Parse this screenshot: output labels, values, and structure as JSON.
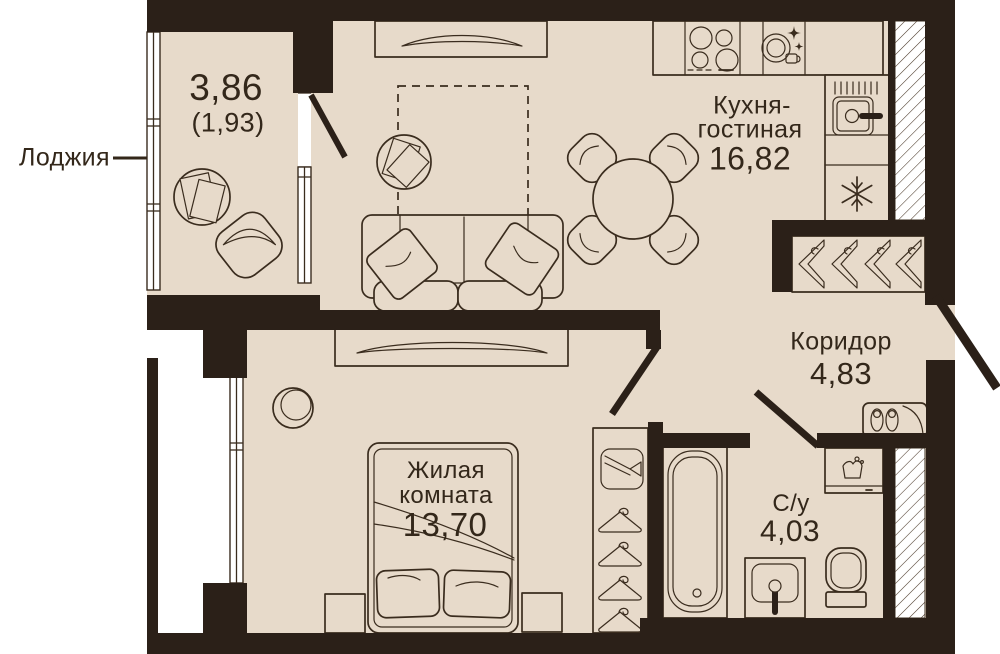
{
  "plan_type": "apartment-floor-plan",
  "colors": {
    "wall": "#2B2018",
    "floor": "#E7DACA",
    "outline": "#3A2C1E",
    "window": "#FFFFFF",
    "hatch_line": "#4A3929",
    "background": "#FFFFFF",
    "text": "#33271A"
  },
  "rooms": [
    {
      "key": "loggia",
      "name": "Лоджия",
      "area": "3,86",
      "area_secondary": "(1,93)"
    },
    {
      "key": "kitchen_living",
      "name_line1": "Кухня-",
      "name_line2": "гостиная",
      "area": "16,82"
    },
    {
      "key": "corridor",
      "name": "Коридор",
      "area": "4,83"
    },
    {
      "key": "bedroom",
      "name_line1": "Жилая",
      "name_line2": "комната",
      "area": "13,70"
    },
    {
      "key": "bathroom",
      "name": "С/у",
      "area": "4,03"
    }
  ],
  "icons": [
    "stove-burners-icon",
    "dishwasher-sparkle-icon",
    "kitchen-sink-icon",
    "fridge-snowflake-icon",
    "dining-table-icon",
    "sofa-icon",
    "tv-console-icon",
    "coffee-table-icon",
    "wardrobe-hangers-icon",
    "shoe-cabinet-slippers-icon",
    "tie-box-icon",
    "bathtub-icon",
    "washing-machine-icon",
    "washbasin-icon",
    "toilet-icon",
    "bed-icon",
    "mirror-icon",
    "loggia-table-icon",
    "loggia-chair-icon",
    "ventilation-shaft-hatch"
  ]
}
